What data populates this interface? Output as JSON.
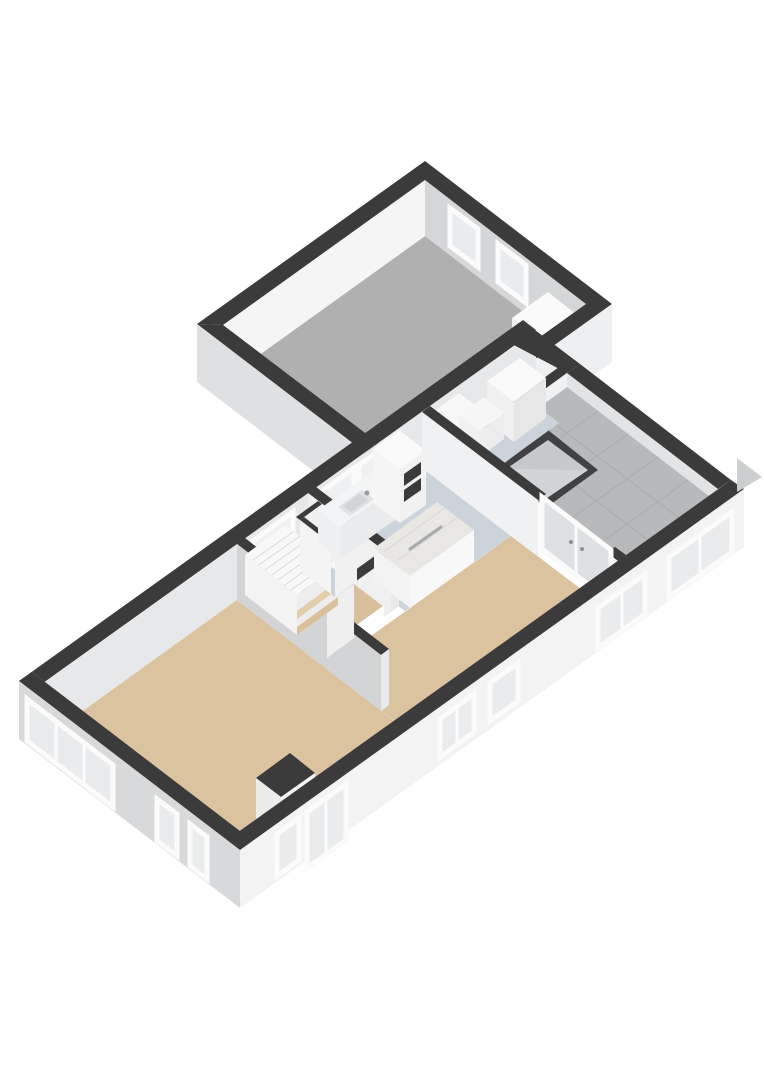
{
  "canvas": {
    "width": 764,
    "height": 1080,
    "background": "#ffffff"
  },
  "palette": {
    "wall_top": "#3b3b3c",
    "facade_front": "#f3f3f4",
    "facade_side": "#d8d9da",
    "floor_wood": "#dcc3a0",
    "floor_kitchen": "#ccd3da",
    "floor_garage": "#b0b0b1",
    "terrace_tile": "#b7b9ba",
    "glass": "#e9ebec",
    "window_frame": "#fbfbfb",
    "skylight_glass": "#c5c9cb"
  },
  "rooms": [
    {
      "id": "garage",
      "floor": "#b0b0b1"
    },
    {
      "id": "living-room",
      "floor": "#dcc3a0"
    },
    {
      "id": "dining-area",
      "floor": "#dcc3a0"
    },
    {
      "id": "stair-hall",
      "floor": "#d9c09d"
    },
    {
      "id": "kitchen",
      "floor": "#ccd3da"
    },
    {
      "id": "utility-room",
      "floor": "#ccd3da"
    },
    {
      "id": "terrace",
      "floor": "#b7b9ba"
    }
  ],
  "shapes": [
    {
      "n": "garage-floor",
      "k": "p",
      "p": "223,381 425,236 586,360 385,504",
      "f": "#b0b0b1"
    },
    {
      "n": "garage-wall-nw-inner-face",
      "k": "p",
      "p": "223,325 425,180 425,236 223,381",
      "f": "#f5f5f6"
    },
    {
      "n": "garage-wall-ne-inner-face",
      "k": "p",
      "p": "425,180 586,304 586,360 425,236",
      "f": "#d6d7d8"
    },
    {
      "n": "garage-window-1",
      "k": "p",
      "p": "450,208 478,229 478,267 450,246",
      "f": "#e9ecee",
      "s": "#fbfbfb",
      "w": 5
    },
    {
      "n": "garage-window-2",
      "k": "p",
      "p": "498,244 526,265 526,303 498,282",
      "f": "#e9ecee",
      "s": "#fbfbfb",
      "w": 5
    },
    {
      "n": "garage-workbench-top",
      "k": "p",
      "p": "512,318 548,292 586,322 550,347",
      "f": "#fafafa"
    },
    {
      "n": "garage-workbench-face-left",
      "k": "p",
      "p": "512,318 550,347 550,385 512,356",
      "f": "#efeff0"
    },
    {
      "n": "garage-workbench-face-right",
      "k": "p",
      "p": "550,347 586,322 586,360 550,385",
      "f": "#e4e4e5"
    },
    {
      "n": "garage-wall-sw-inner-face",
      "k": "p",
      "p": "223,325 385,448 385,504 223,381",
      "f": "#cbcccd"
    },
    {
      "n": "roller-door",
      "k": "p",
      "p": "237,341 372,444 372,492 237,389",
      "f": "#c3c4c5"
    },
    {
      "n": "roller-door-slat-1",
      "k": "l",
      "p": "237,347 372,450",
      "s": "#aeaeaf",
      "w": 1
    },
    {
      "n": "roller-door-slat-2",
      "k": "l",
      "p": "237,353 372,456",
      "s": "#aeaeaf",
      "w": 1
    },
    {
      "n": "roller-door-slat-3",
      "k": "l",
      "p": "237,359 372,462",
      "s": "#aeaeaf",
      "w": 1
    },
    {
      "n": "roller-door-slat-4",
      "k": "l",
      "p": "237,365 372,468",
      "s": "#aeaeaf",
      "w": 1
    },
    {
      "n": "roller-door-slat-5",
      "k": "l",
      "p": "237,371 372,474",
      "s": "#aeaeaf",
      "w": 1
    },
    {
      "n": "roller-door-slat-6",
      "k": "l",
      "p": "237,377 372,480",
      "s": "#aeaeaf",
      "w": 1
    },
    {
      "n": "roller-door-slat-7",
      "k": "l",
      "p": "237,383 372,486",
      "s": "#aeaeaf",
      "w": 1
    },
    {
      "n": "garage-wall-top-nw",
      "k": "p",
      "p": "197,324 425,161 425,180 223,325",
      "f": "#3b3b3c"
    },
    {
      "n": "garage-wall-top-ne",
      "k": "p",
      "p": "425,161 612,304 586,304 425,180",
      "f": "#3b3b3c"
    },
    {
      "n": "garage-wall-top-sw",
      "k": "p",
      "p": "197,324 384,467 385,448 223,325",
      "f": "#3b3b3c"
    },
    {
      "n": "garage-wall-top-se",
      "k": "p",
      "p": "384,467 612,304 586,304 385,448",
      "f": "#3b3b3c"
    },
    {
      "n": "garage-exterior-face-sw",
      "k": "p",
      "p": "197,324 384,467 384,525 197,382",
      "f": "#dfe0e1"
    },
    {
      "n": "garage-face-se",
      "k": "p",
      "p": "384,467 612,304 612,362 384,525",
      "f": "#eeeff0"
    },
    {
      "n": "main-back-wall-top",
      "k": "p",
      "p": "19,681 523,320 536,330 32,691",
      "f": "#3b3b3c"
    },
    {
      "n": "terrace-inner-face-right",
      "k": "p",
      "p": "718,489 567,373 567,387 718,503",
      "f": "#e2e3e4"
    },
    {
      "n": "terrace-floor",
      "k": "p",
      "p": "475,454 567,387 718,503 626,569",
      "f": "#b7b9ba"
    },
    {
      "n": "terrace-tile-line-1",
      "k": "l",
      "p": "596,546 688,480",
      "s": "#aaacad",
      "w": 1
    },
    {
      "n": "terrace-tile-line-2",
      "k": "l",
      "p": "565,523 658,457",
      "s": "#aaacad",
      "w": 1
    },
    {
      "n": "terrace-tile-line-3",
      "k": "l",
      "p": "535,500 628,434",
      "s": "#aaacad",
      "w": 1
    },
    {
      "n": "terrace-tile-line-4",
      "k": "l",
      "p": "505,477 598,411",
      "s": "#aaacad",
      "w": 1
    },
    {
      "n": "terrace-tile-line-5",
      "k": "l",
      "p": "657,547 506,432",
      "s": "#aaacad",
      "w": 1
    },
    {
      "n": "terrace-tile-line-6",
      "k": "l",
      "p": "688,525 536,410",
      "s": "#aaacad",
      "w": 1
    },
    {
      "n": "terrace-inner-face-front",
      "k": "p",
      "p": "626,555 731,480 731,494 626,569",
      "f": "#e8e9ea"
    },
    {
      "n": "skylight-frame",
      "k": "p",
      "p": "498,468 548,430 598,470 547,507",
      "f": "#404142"
    },
    {
      "n": "skylight-glass",
      "k": "p",
      "p": "506,469 548,440 588,470 547,498",
      "f": "#c5c9cb"
    },
    {
      "n": "skylight-sheen",
      "k": "p",
      "p": "506,469 588,470 547,498",
      "f": "#d0d4d6"
    },
    {
      "n": "back-wall-inner-face",
      "k": "p",
      "p": "32,691 536,330 536,386 32,747",
      "f": "#e7e8e9"
    },
    {
      "n": "hall-back-window",
      "k": "p",
      "p": "253,541 293,512 293,552 253,581",
      "f": "#eef0f1",
      "s": "#fbfbfb",
      "w": 5
    },
    {
      "n": "kitchen-window-1",
      "k": "p",
      "p": "321,492 354,468 354,508 321,532",
      "f": "#eef0f1",
      "s": "#fbfbfb",
      "w": 5
    },
    {
      "n": "kitchen-window-2",
      "k": "p",
      "p": "359,465 391,442 391,482 359,505",
      "f": "#eef0f1",
      "s": "#fbfbfb",
      "w": 5
    },
    {
      "n": "front-wall-inner-face",
      "k": "p",
      "p": "227,840 626,555 626,611 227,896",
      "f": "#f1f2f2"
    },
    {
      "n": "left-wall-inner-face",
      "k": "p",
      "p": "253,841 32,672 32,728 253,897",
      "f": "#f6f6f7"
    },
    {
      "n": "living-room-floor",
      "k": "p",
      "p": "45,738 237,600 432,750 240,887",
      "f": "#dcc3a0"
    },
    {
      "n": "dining-area-floor",
      "k": "p",
      "p": "326,668 511,536 618,617 440,744 432,750",
      "f": "#dcc3a0"
    },
    {
      "n": "kitchen-floor",
      "k": "p",
      "p": "316,543 422,468 511,536 405,611",
      "f": "#ccd3da"
    },
    {
      "n": "hall-floor",
      "k": "p",
      "p": "245,595 308,549 383,606 319,652",
      "f": "#d9c09d"
    },
    {
      "n": "utility-floor",
      "k": "p",
      "p": "430,462 523,395 559,423 467,490",
      "f": "#ccd3da"
    },
    {
      "n": "utility-front-wall-top",
      "k": "p",
      "p": "467,434 559,367 567,373 475,440",
      "f": "#3b3b3c"
    },
    {
      "n": "utility-right-wall-top",
      "k": "p",
      "p": "580,364 523,321 510,343 567,373",
      "f": "#3b3b3c"
    },
    {
      "n": "utility-front-wall-face",
      "k": "p",
      "p": "475,440 567,373 567,387 475,454",
      "f": "#f0f1f2"
    },
    {
      "n": "utility-appliance-top",
      "k": "p",
      "p": "487,381 520,358 546,378 514,402",
      "f": "#fafafa"
    },
    {
      "n": "utility-appliance-face-left",
      "k": "p",
      "p": "487,381 514,402 514,442 487,421",
      "f": "#f0f0f1"
    },
    {
      "n": "utility-appliance-face-right",
      "k": "p",
      "p": "514,402 546,378 546,418 514,442",
      "f": "#e7e7e8"
    },
    {
      "n": "utility-cabinet-tall-top",
      "k": "p",
      "p": "432,413 459,393 483,411 456,431",
      "f": "#f8f8f9"
    },
    {
      "n": "utility-cabinet-tall-face-left",
      "k": "p",
      "p": "432,413 456,431 456,479 432,461",
      "f": "#f4f4f5"
    },
    {
      "n": "utility-cabinet-tall-face-front",
      "k": "p",
      "p": "456,431 483,411 483,459 456,479",
      "f": "#f0f0f1"
    },
    {
      "n": "utility-cabinet-low-top",
      "k": "p",
      "p": "459,415 484,397 504,413 480,431",
      "f": "#f6f6f7"
    },
    {
      "n": "utility-cabinet-low-face-left",
      "k": "p",
      "p": "459,415 480,431 480,457 459,441",
      "f": "#f1f1f2"
    },
    {
      "n": "utility-cabinet-low-face-front",
      "k": "p",
      "p": "480,431 504,413 504,439 480,457",
      "f": "#ededee"
    },
    {
      "n": "wall-living-dining-top",
      "k": "p",
      "p": "237,544 245,538 389,649 381,655",
      "f": "#3b3b3c"
    },
    {
      "n": "wall-living-dining-face",
      "k": "p",
      "p": "237,544 381,655 381,711 237,600",
      "f": "#d3d4d5"
    },
    {
      "n": "wall-living-dining-end-face",
      "k": "p",
      "p": "381,655 389,649 389,705 381,711",
      "f": "#eaeaeb"
    },
    {
      "n": "wall-hall-kitchen-top",
      "k": "p",
      "p": "308,493 316,487 399,550 391,556",
      "f": "#3b3b3c"
    },
    {
      "n": "wall-hall-kitchen-face",
      "k": "p",
      "p": "308,493 391,556 391,612 308,549",
      "f": "#f0f0f1"
    },
    {
      "n": "wall-hall-kitchen-end-face",
      "k": "p",
      "p": "391,556 399,550 399,606 391,612",
      "f": "#e8e8e9"
    },
    {
      "n": "wall-hall-front-top",
      "k": "p",
      "p": "319,596 383,550 391,556 327,602",
      "f": "#3b3b3c"
    },
    {
      "n": "wall-hall-front-face-1",
      "k": "p",
      "p": "327,602 354,582 354,638 327,658",
      "f": "#efeff0"
    },
    {
      "n": "wall-hall-front-face-2",
      "k": "p",
      "p": "384,561 391,556 391,612 384,617",
      "f": "#efeff0"
    },
    {
      "n": "staircase-top",
      "k": "p",
      "p": "245,555 285,525 338,565 297,595",
      "f": "#f8f8f9"
    },
    {
      "n": "stair-tread-1",
      "k": "l",
      "p": "291,590 332,561",
      "s": "#d8d8d9",
      "w": 1
    },
    {
      "n": "stair-tread-2",
      "k": "l",
      "p": "285,585 325,556",
      "s": "#d8d8d9",
      "w": 1
    },
    {
      "n": "stair-tread-3",
      "k": "l",
      "p": "278,580 319,551",
      "s": "#d8d8d9",
      "w": 1
    },
    {
      "n": "stair-tread-4",
      "k": "l",
      "p": "272,575 312,546",
      "s": "#d8d8d9",
      "w": 1
    },
    {
      "n": "stair-tread-5",
      "k": "l",
      "p": "265,570 306,541",
      "s": "#d8d8d9",
      "w": 1
    },
    {
      "n": "stair-tread-6",
      "k": "l",
      "p": "259,565 300,536",
      "s": "#d8d8d9",
      "w": 1
    },
    {
      "n": "stair-tread-7",
      "k": "l",
      "p": "253,560 293,532",
      "s": "#d8d8d9",
      "w": 1
    },
    {
      "n": "staircase-front-face",
      "k": "p",
      "p": "297,595 338,565 338,605 297,635",
      "f": "#ededee"
    },
    {
      "n": "stair-step-low-1",
      "k": "p",
      "p": "297,627 338,597 338,605 297,635",
      "f": "#d9bf9b"
    },
    {
      "n": "stair-step-low-2",
      "k": "p",
      "p": "297,611 338,581 338,589 297,619",
      "f": "#e4cdaa"
    },
    {
      "n": "staircase-left-face",
      "k": "p",
      "p": "245,555 297,595 297,635 245,595",
      "f": "#f3f3f4"
    },
    {
      "n": "toilet-wall-top-back",
      "k": "p",
      "p": "296,517 318,501 322,504 300,520",
      "f": "#3b3b3c"
    },
    {
      "n": "toilet-wall-top-left",
      "k": "p",
      "p": "300,520 304,517 335,541 331,544",
      "f": "#3b3b3c"
    },
    {
      "n": "toilet-wall-top-front",
      "k": "p",
      "p": "331,544 354,528 357,531 335,547",
      "f": "#3b3b3c"
    },
    {
      "n": "toilet-floor",
      "k": "p",
      "p": "308,576 326,563 354,584 335,597",
      "f": "#ccd3da"
    },
    {
      "n": "toilet-wall-face-front",
      "k": "p",
      "p": "335,547 357,531 357,581 335,597",
      "f": "#f1f1f2"
    },
    {
      "n": "toilet-wall-face-left",
      "k": "p",
      "p": "300,520 331,544 331,594 300,570",
      "f": "#f4f4f5"
    },
    {
      "n": "kitchen-counter-top",
      "k": "p",
      "p": "318,510 373,471 395,488 340,527",
      "f": "#f3f4f5"
    },
    {
      "n": "kitchen-counter-face-front",
      "k": "p",
      "p": "340,527 395,488 395,520 340,559",
      "f": "#eaebec"
    },
    {
      "n": "kitchen-counter-face-left",
      "k": "p",
      "p": "318,510 340,527 340,559 318,542",
      "f": "#eeeff0"
    },
    {
      "n": "kitchen-sink-outer",
      "k": "p",
      "p": "338,507 362,490 374,499 350,516",
      "f": "#e0e2e4"
    },
    {
      "n": "kitchen-sink-basin",
      "k": "p",
      "p": "343,506 360,494 368,500 351,512",
      "f": "#d2d5d7"
    },
    {
      "n": "kitchen-faucet",
      "k": "c",
      "cx": 367,
      "cy": 493,
      "r": 2.5,
      "f": "#999c9e"
    },
    {
      "n": "oven-column-top",
      "k": "p",
      "p": "373,449 399,430 426,451 400,469",
      "f": "#fafafa"
    },
    {
      "n": "oven-column-face-left",
      "k": "p",
      "p": "373,449 400,469 400,523 373,503",
      "f": "#f5f5f6"
    },
    {
      "n": "oven-column-face-front",
      "k": "p",
      "p": "400,469 426,451 426,505 400,523",
      "f": "#f1f1f2"
    },
    {
      "n": "oven-upper",
      "k": "p",
      "p": "404,474 421,462 421,474 404,486",
      "f": "#3a3a3b"
    },
    {
      "n": "oven-lower",
      "k": "p",
      "p": "404,490 421,478 421,490 404,502",
      "f": "#3a3a3b"
    },
    {
      "n": "kitchen-island-top",
      "k": "p",
      "p": "374,548 437,502 474,530 410,576",
      "f": "#e9e7e4"
    },
    {
      "n": "island-marble-streak-1",
      "k": "l",
      "p": "385,551 445,508",
      "s": "#d9d6d2",
      "w": 1
    },
    {
      "n": "island-marble-streak-2",
      "k": "l",
      "p": "398,560 458,517",
      "s": "#d9d6d2",
      "w": 1
    },
    {
      "n": "island-hob-strip",
      "k": "l",
      "p": "410,549 441,527",
      "s": "#a7abae",
      "w": 3
    },
    {
      "n": "kitchen-island-face-left",
      "k": "p",
      "p": "374,548 410,576 410,608 374,580",
      "f": "#f3f3f4"
    },
    {
      "n": "kitchen-island-face-front",
      "k": "p",
      "p": "410,576 474,530 474,562 410,608",
      "f": "#f8f8f8"
    },
    {
      "n": "wall-dining-terrace-top",
      "k": "p",
      "p": "422,412 430,406 546,494 538,500",
      "f": "#3b3b3c"
    },
    {
      "n": "wall-dining-terrace-face",
      "k": "p",
      "p": "422,412 538,500 538,556 422,468",
      "f": "#f0f1f2"
    },
    {
      "n": "wall-front-stub-top",
      "k": "p",
      "p": "606,552 615,547 626,555 618,561",
      "f": "#3b3b3c"
    },
    {
      "n": "wall-front-stub-face",
      "k": "p",
      "p": "606,552 618,561 618,617 606,608",
      "f": "#f0f1f2"
    },
    {
      "n": "french-doors-glass",
      "k": "p",
      "p": "542,497 611,550 611,602 542,549",
      "f": "#dde1e3",
      "s": "#fafafa",
      "w": 5
    },
    {
      "n": "french-doors-mullion",
      "k": "l",
      "p": "576,524 576,576",
      "s": "#fafafa",
      "w": 3
    },
    {
      "n": "french-door-handle-1",
      "k": "c",
      "cx": 571,
      "cy": 542,
      "r": 2,
      "f": "#8f9294"
    },
    {
      "n": "french-door-handle-2",
      "k": "c",
      "cx": 582,
      "cy": 549,
      "r": 2,
      "f": "#8f9294"
    },
    {
      "n": "chimney-top",
      "k": "p",
      "p": "256,778 290,753 315,773 281,797",
      "f": "#3b3b3c"
    },
    {
      "n": "chimney-face-sw",
      "k": "p",
      "p": "256,778 281,797 281,847 256,828",
      "f": "#ececed"
    },
    {
      "n": "chimney-face-se",
      "k": "p",
      "p": "281,797 315,773 315,823 281,847",
      "f": "#f5f5f6"
    },
    {
      "n": "main-right-wall-top",
      "k": "p",
      "p": "731,480 580,364 567,373 718,489",
      "f": "#3b3b3c"
    },
    {
      "n": "front-wall-top",
      "k": "p",
      "p": "240,850 744,489 731,480 227,840",
      "f": "#3b3b3c"
    },
    {
      "n": "left-wall-top",
      "k": "p",
      "p": "240,850 19,681 32,672 253,841",
      "f": "#3b3b3c"
    },
    {
      "n": "front-facade-face",
      "k": "p",
      "p": "240,850 744,489 744,547 240,908",
      "f": "#f3f3f4"
    },
    {
      "n": "left-facade-face",
      "k": "p",
      "p": "240,850 19,681 19,739 240,908",
      "f": "#d8d9da"
    },
    {
      "n": "front-window-1",
      "k": "p",
      "p": "277,834 299,818 299,860 277,876",
      "f": "#e9ebec",
      "s": "#fbfbfb",
      "w": 5
    },
    {
      "n": "front-window-2",
      "k": "p",
      "p": "307,812 346,784 346,840 307,868",
      "f": "#e9ebec",
      "s": "#fbfbfb",
      "w": 5
    },
    {
      "n": "front-window-2-mullion",
      "k": "l",
      "p": "326,798 326,854",
      "s": "#fbfbfb",
      "w": 3
    },
    {
      "n": "front-window-3",
      "k": "p",
      "p": "440,719 474,694 474,732 440,757",
      "f": "#e9ebec",
      "s": "#fbfbfb",
      "w": 5
    },
    {
      "n": "front-window-3-mullion",
      "k": "l",
      "p": "457,707 457,745",
      "s": "#fbfbfb",
      "w": 3
    },
    {
      "n": "front-window-4",
      "k": "p",
      "p": "490,683 518,663 518,701 490,721",
      "f": "#e9ebec",
      "s": "#fbfbfb",
      "w": 5
    },
    {
      "n": "front-window-5",
      "k": "p",
      "p": "598,608 645,574 645,614 598,648",
      "f": "#e9ebec",
      "s": "#fbfbfb",
      "w": 5
    },
    {
      "n": "front-window-5-mullion",
      "k": "l",
      "p": "622,591 622,631",
      "s": "#fbfbfb",
      "w": 3
    },
    {
      "n": "front-window-6",
      "k": "p",
      "p": "669,557 732,512 732,552 669,597",
      "f": "#e9ebec",
      "s": "#fbfbfb",
      "w": 5
    },
    {
      "n": "front-window-6-mullion",
      "k": "l",
      "p": "700,535 700,575",
      "s": "#fbfbfb",
      "w": 3
    },
    {
      "n": "left-corner-window",
      "k": "p",
      "p": "27,699 113,765 113,807 27,741",
      "f": "#e9ebec",
      "s": "#fbfbfb",
      "w": 5
    },
    {
      "n": "left-corner-window-mullion-1",
      "k": "l",
      "p": "56,721 56,763",
      "s": "#fbfbfb",
      "w": 3
    },
    {
      "n": "left-corner-window-mullion-2",
      "k": "l",
      "p": "84,743 84,785",
      "s": "#fbfbfb",
      "w": 3
    },
    {
      "n": "left-window-2",
      "k": "p",
      "p": "157,799 177,814 177,856 157,841",
      "f": "#e9ebec",
      "s": "#fbfbfb",
      "w": 5
    },
    {
      "n": "left-window-3",
      "k": "p",
      "p": "190,824 207,837 207,879 190,866",
      "f": "#e9ebec",
      "s": "#fbfbfb",
      "w": 5
    },
    {
      "n": "exterior-wall-stub",
      "k": "p",
      "p": "737,458 762,477 737,492",
      "f": "#cdced0"
    }
  ]
}
